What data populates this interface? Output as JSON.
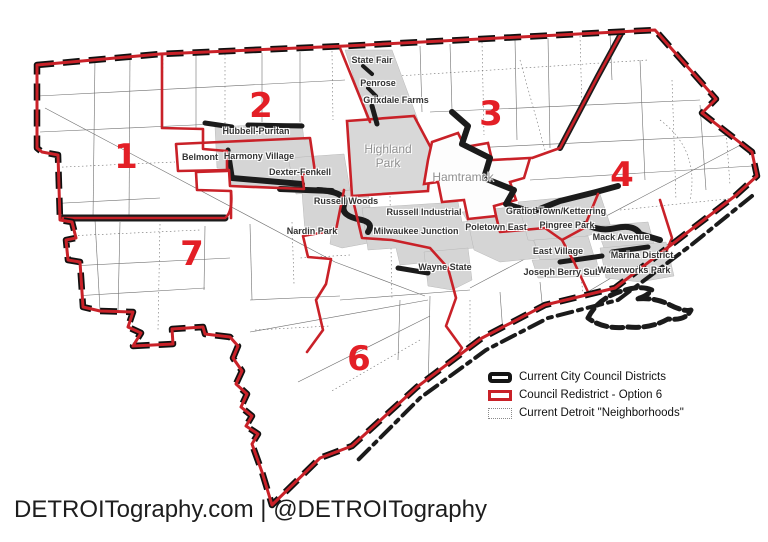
{
  "map": {
    "colors": {
      "red_line": "#c92128",
      "district_number": "#e31f26",
      "black_line": "#1b1b1b",
      "gray_fill": "#d5d5d5",
      "neighborhood_line": "#6f6f6f",
      "label_text": "#333333",
      "enclave_text": "#8f8f8f"
    },
    "district_numbers": [
      {
        "label": "1",
        "x": 126,
        "y": 157
      },
      {
        "label": "2",
        "x": 261,
        "y": 106
      },
      {
        "label": "3",
        "x": 491,
        "y": 114
      },
      {
        "label": "4",
        "x": 622,
        "y": 175
      },
      {
        "label": "6",
        "x": 359,
        "y": 359
      },
      {
        "label": "7",
        "x": 192,
        "y": 254
      }
    ],
    "enclave_labels": [
      {
        "text": "Highland\nPark",
        "x": 388,
        "y": 156
      },
      {
        "text": "Hamtramck",
        "x": 463,
        "y": 177
      }
    ],
    "neighborhood_labels": [
      {
        "text": "State Fair",
        "x": 372,
        "y": 60
      },
      {
        "text": "Penrose",
        "x": 378,
        "y": 83
      },
      {
        "text": "Grixdale Farms",
        "x": 396,
        "y": 100
      },
      {
        "text": "Hubbell-Puritan",
        "x": 256,
        "y": 131
      },
      {
        "text": "Belmont",
        "x": 200,
        "y": 157
      },
      {
        "text": "Harmony Village",
        "x": 259,
        "y": 156
      },
      {
        "text": "Dexter-Fenkell",
        "x": 300,
        "y": 172
      },
      {
        "text": "Russell Woods",
        "x": 346,
        "y": 201
      },
      {
        "text": "Russell Industrial",
        "x": 424,
        "y": 212
      },
      {
        "text": "Nardin Park",
        "x": 312,
        "y": 231
      },
      {
        "text": "Milwaukee Junction",
        "x": 416,
        "y": 231
      },
      {
        "text": "Poletown East",
        "x": 496,
        "y": 227
      },
      {
        "text": "Gratiot Town/Ketterring",
        "x": 556,
        "y": 211
      },
      {
        "text": "Pingree  Park",
        "x": 567,
        "y": 225
      },
      {
        "text": "Mack Avenue",
        "x": 621,
        "y": 237
      },
      {
        "text": "East Village",
        "x": 558,
        "y": 251
      },
      {
        "text": "Marina District",
        "x": 642,
        "y": 255
      },
      {
        "text": "Joseph Berry Sub",
        "x": 562,
        "y": 272
      },
      {
        "text": "Waterworks Park",
        "x": 634,
        "y": 270
      },
      {
        "text": "Wayne State",
        "x": 445,
        "y": 267
      }
    ]
  },
  "legend": {
    "items": [
      {
        "symbol": "thick-black-line",
        "label": "Current City Council Districts"
      },
      {
        "symbol": "red-outline",
        "label": "Council Redistrict - Option 6"
      },
      {
        "symbol": "dotted-outline",
        "label": "Current Detroit \"Neighborhoods\""
      }
    ]
  },
  "footer": {
    "text": "DETROITography.com | @DETROITography"
  }
}
